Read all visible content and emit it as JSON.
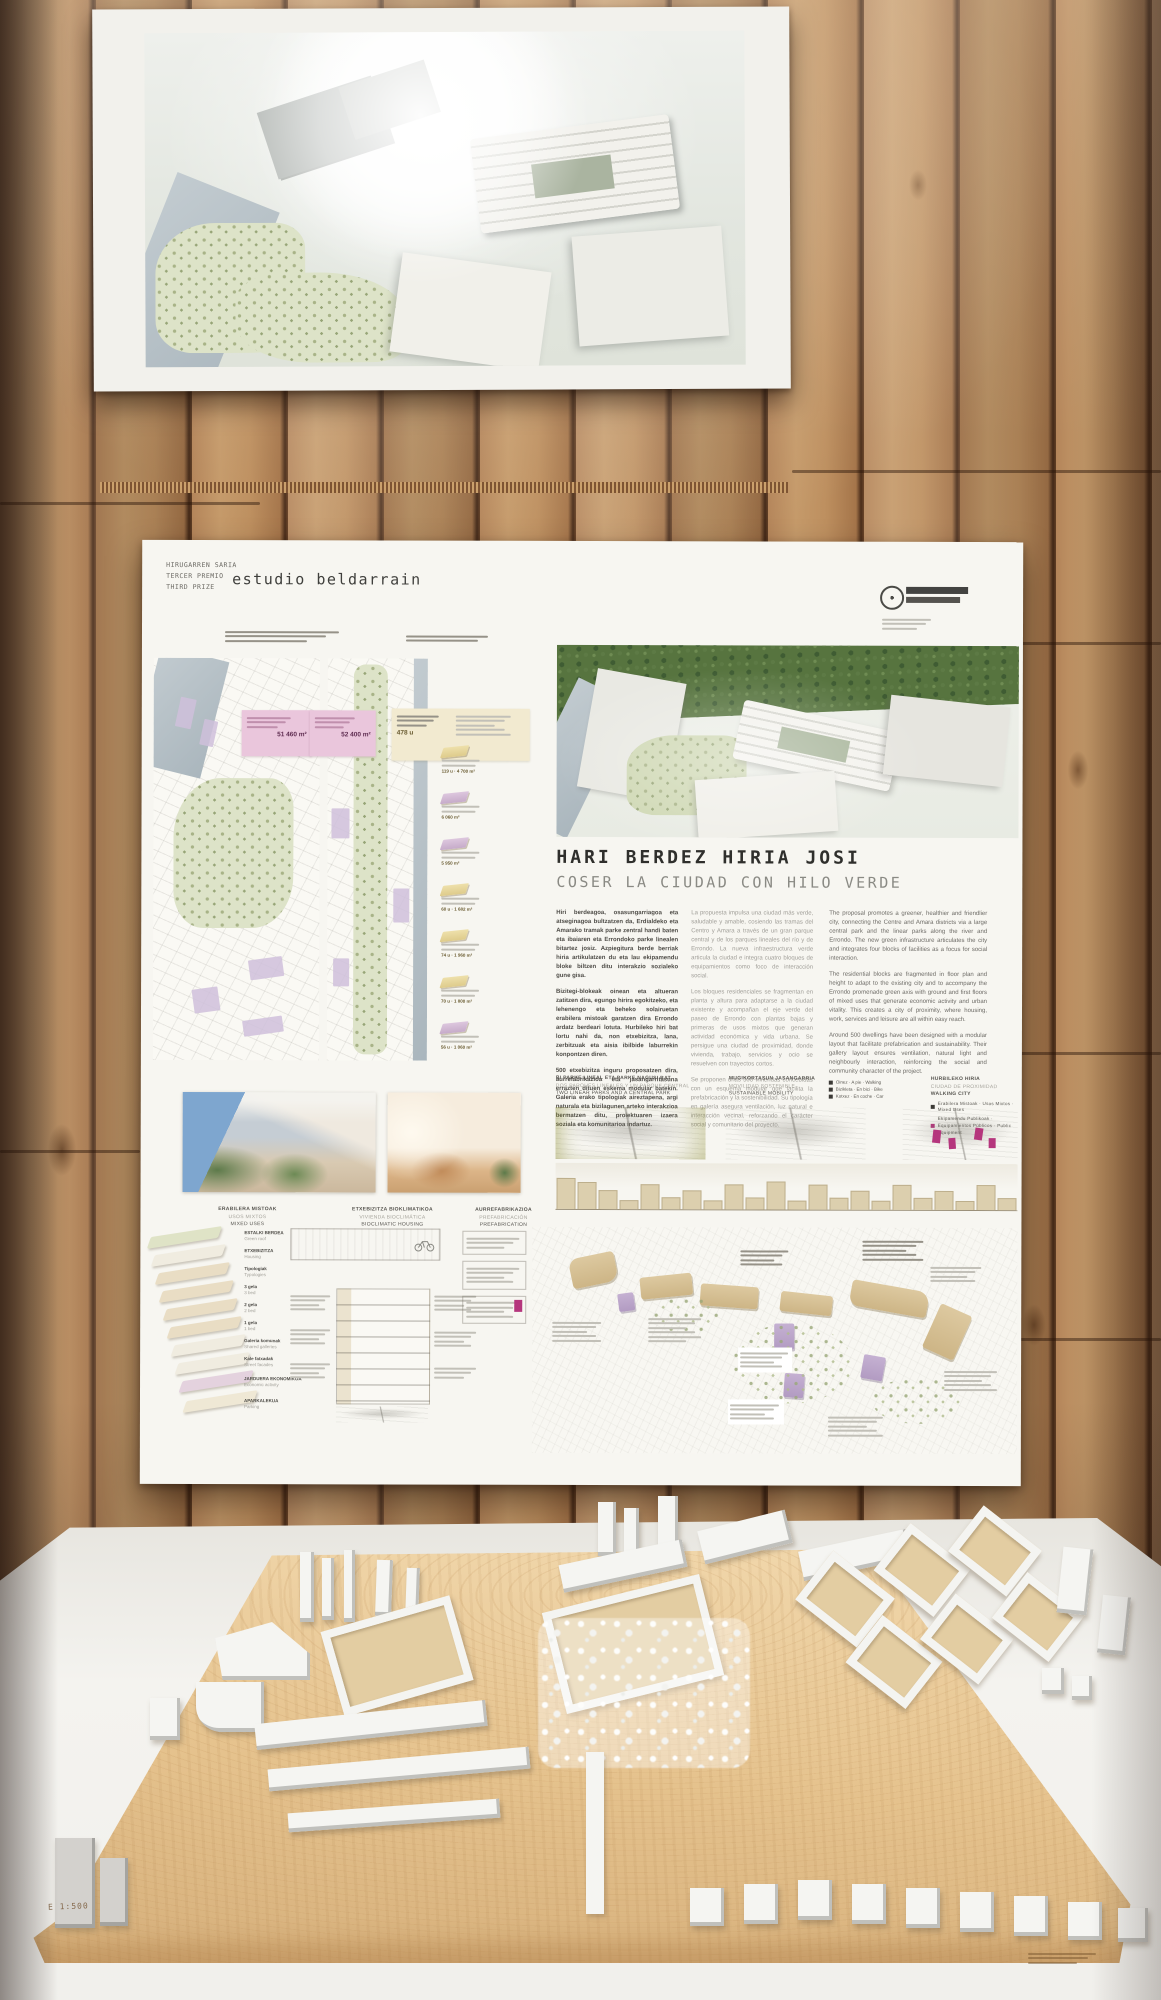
{
  "panel": {
    "prize_lines": [
      "HIRUGARREN SARIA",
      "TERCER PREMIO",
      "THIRD PRIZE"
    ],
    "studio_name": "estudio beldarrain",
    "title": {
      "eu": "HARI BERDEZ HIRIA JOSI",
      "es": "COSER LA CIUDAD CON HILO VERDE"
    },
    "intro": {
      "eu": [
        "Hiri berdeagoa, osasungarriagoa eta atseginagoa bultzatzen da, Erdialdeko eta Amarako tramak parke zentral handi baten eta ibaiaren eta Errondoko parke linealen bitartez josiz. Azpiegitura berde berriak hiria artikulatzen du eta lau ekipamendu bloke biltzen ditu interakzio sozialeko gune gisa.",
        "Bizitegi-blokeak oinean eta altueran zatitzen dira, egungo hirira egokitzeko, eta lehenengo eta beheko solairuetan erabilera mistoak garatzen dira Errondo ardatz berdeari lotuta. Hurbileko hiri bat lortu nahi da, non etxebizitza, lana, zerbitzuak eta aisia ibilbide laburrekin konpontzen diren.",
        "500 etxebizitza inguru proposatzen dira, aurrefabrikazioa eta jasangarritasuna errazten dituen eskema modular batekin. Galeria erako tipologiak aireztapena, argi naturala eta bizilagunen arteko interakzioa bermatzen ditu, proiektuaren izaera soziala eta komunitarioa indartuz."
      ],
      "es": [
        "La propuesta impulsa una ciudad más verde, saludable y amable, cosiendo las tramas del Centro y Amara a través de un gran parque central y de los parques lineales del río y de Errondo. La nueva infraestructura verde articula la ciudad e integra cuatro bloques de equipamientos como foco de interacción social.",
        "Los bloques residenciales se fragmentan en planta y altura para adaptarse a la ciudad existente y acompañan el eje verde del paseo de Errondo con plantas bajas y primeras de usos mixtos que generan actividad económica y vida urbana. Se persigue una ciudad de proximidad, donde vivienda, trabajo, servicios y ocio se resuelven con trayectos cortos.",
        "Se proponen unas 500 viviendas concebidas con un esquema modular que facilita la prefabricación y la sostenibilidad. Su tipología en galería asegura ventilación, luz natural e interacción vecinal, reforzando el carácter social y comunitario del proyecto."
      ],
      "en": [
        "The proposal promotes a greener, healthier and friendlier city, connecting the Centre and Amara districts via a large central park and the linear parks along the river and Errondo. The new green infrastructure articulates the city and integrates four blocks of facilities as a focus for social interaction.",
        "The residential blocks are fragmented in floor plan and height to adapt to the existing city and to accompany the Errondo promenade green axis with ground and first floors of mixed uses that generate economic activity and urban vitality. This creates a city of proximity, where housing, work, services and leisure are all within easy reach.",
        "Around 500 dwellings have been designed with a modular layout that facilitate prefabrication and sustainability. Their gallery layout ensures ventilation, natural light and neighbourly interaction, reinforcing the social and community character of the project."
      ]
    },
    "site_data": {
      "area1": "51 460 m²",
      "area2": "52 400 m²",
      "units": "478 u"
    },
    "legend_items": [
      {
        "value": "119 u · 4 700 m²"
      },
      {
        "value": "6 060 m²"
      },
      {
        "value": "5 950 m²"
      },
      {
        "value": "60 u · 1 682 m²"
      },
      {
        "value": "74 u · 1 960 m²"
      },
      {
        "value": "70 u · 1 800 m²"
      },
      {
        "value": "56 u · 1 060 m²"
      }
    ],
    "diagrams": {
      "parks": {
        "eu": "BI PARKE LINEAL ETA PARKE NAGUSI BAT",
        "es": "DOS PARQUES LINEALES Y UN PARQUE CENTRAL",
        "en": "TWO LINEAR PARKS AND A CENTRAL PARK"
      },
      "mobility": {
        "eu": "MUGIKORTASUN JASANGARRIA",
        "es": "MOVILIDAD SOSTENIBLE",
        "en": "SUSTAINABLE MOBILITY",
        "legend": [
          {
            "label": "Oinez · A pie · Walking"
          },
          {
            "label": "Bizikleta · En bici · Bike"
          },
          {
            "label": "Kotxez · En coche · Car"
          }
        ]
      },
      "proximity": {
        "eu": "HURBILEKO HIRIA",
        "es": "CIUDAD DE PROXIMIDAD",
        "en": "WALKING CITY",
        "legend": [
          {
            "label": "Erabilera Mistoak · Usos Mixtos · Mixed Uses"
          },
          {
            "label": "Ekipamendu Publikoak · Equipamientos Públicos · Public Equipment"
          }
        ]
      }
    },
    "sections": {
      "mixed_uses": {
        "eu": "ERABILERA MISTOAK",
        "es": "USOS MIXTOS",
        "en": "MIXED USES"
      },
      "bioclimatic": {
        "eu": "ETXEBIZITZA BIOKLIMATIKOA",
        "es": "VIVIENDA BIOCLIMÁTICA",
        "en": "BIOCLIMATIC HOUSING"
      },
      "prefabrication": {
        "eu": "AURREFABRIKAZIOA",
        "es": "PREFABRICACIÓN",
        "en": "PREFABRICATION"
      }
    },
    "stack_labels": [
      {
        "eu": "ESTALKI BERDEA",
        "en": "Green roof"
      },
      {
        "eu": "ETXEBIZITZA",
        "en": "Housing"
      },
      {
        "eu": "Tipologiak",
        "en": "Typologies"
      },
      {
        "eu": "3 gela",
        "en": "3 bed"
      },
      {
        "eu": "2 gela",
        "en": "2 bed"
      },
      {
        "eu": "1 gela",
        "en": "1 bed"
      },
      {
        "eu": "Galeria komunak",
        "en": "Shared galleries"
      },
      {
        "eu": "Kale fatxadak",
        "en": "Street facades"
      },
      {
        "eu": "JARDUERA EKONOMIKOA",
        "en": "Economic activity"
      },
      {
        "eu": "APARKALEKUA",
        "en": "Parking"
      }
    ],
    "colors": {
      "accent_magenta": "#b5367d",
      "accent_pink": "#eac6dc",
      "accent_cream": "#f2ead0"
    }
  },
  "model": {
    "scale_stamp": "E 1:500"
  }
}
